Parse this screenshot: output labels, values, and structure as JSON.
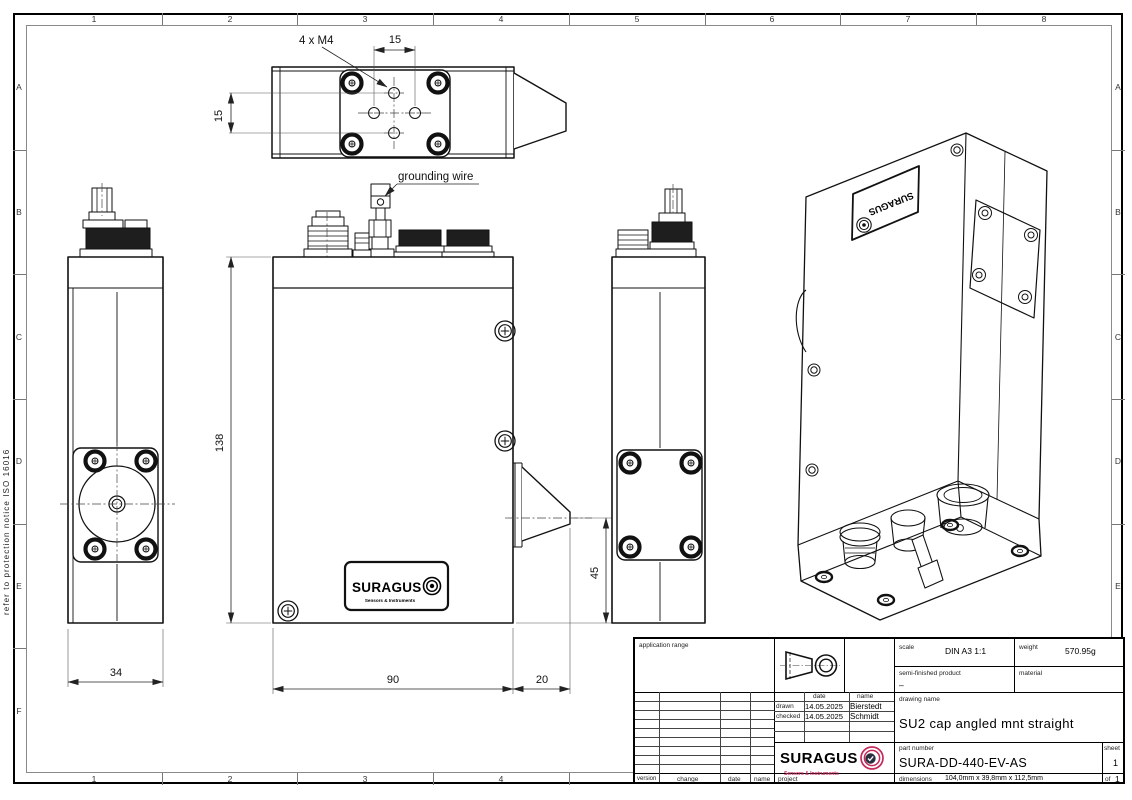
{
  "frame": {
    "cols": [
      "1",
      "2",
      "3",
      "4",
      "5",
      "6",
      "7",
      "8"
    ],
    "rows": [
      "A",
      "B",
      "C",
      "D",
      "E",
      "F"
    ],
    "protection_notice": "refer to protection notice ISO 16016"
  },
  "drawing": {
    "thread_callout": "4 x M4",
    "dim_hole_spacing_h": "15",
    "dim_hole_spacing_v": "15",
    "dim_height": "138",
    "dim_side_width": "34",
    "dim_front_width": "90",
    "dim_cone_length": "20",
    "dim_cone_height": "45",
    "grounding_label": "grounding wire"
  },
  "logo": {
    "name": "SURAGUS",
    "tagline": "Sensors & Instruments",
    "accent": "#c4295a",
    "check_bg": "#2b3040"
  },
  "title_block": {
    "application_range_label": "application range",
    "scale_label": "scale",
    "scale_value": "DIN A3  1:1",
    "weight_label": "weight",
    "weight_value": "570.95g",
    "semi_finished_label": "semi-finished  product",
    "semi_finished_value": "–",
    "material_label": "material",
    "date_header": "date",
    "name_header": "name",
    "drawn_label": "drawn",
    "drawn_date": "14.05.2025",
    "drawn_name": "Bierstedt",
    "checked_label": "checked",
    "checked_date": "14.05.2025",
    "checked_name": "Schmidt",
    "drawing_name_label": "drawing  name",
    "drawing_name_value": "SU2 cap angled mnt straight",
    "part_number_label": "part  number",
    "part_number_value": "SURA-DD-440-EV-AS",
    "sheet_label": "sheet",
    "sheet_value": "1",
    "version_label": "version",
    "change_label": "change",
    "date_label": "date",
    "name_label": "name",
    "project_label": "project",
    "dimensions_label": "dimensions",
    "dimensions_value": "104,0mm x 39,8mm x 112,5mm",
    "of_label": "of",
    "of_value": "1"
  }
}
